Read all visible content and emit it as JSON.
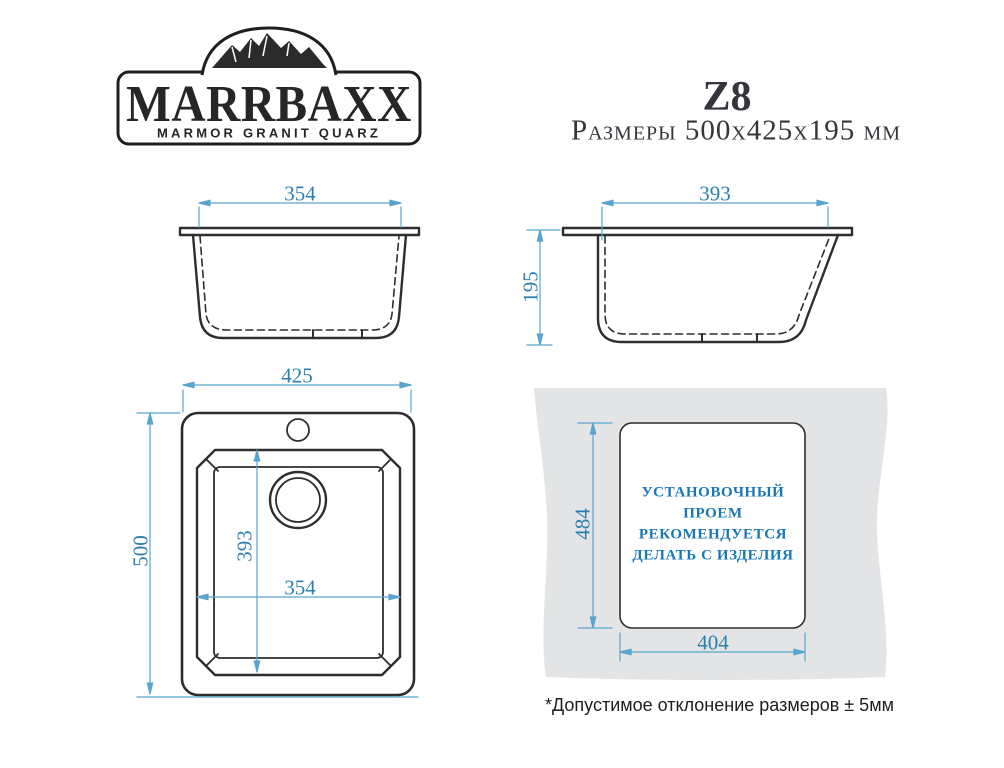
{
  "logo": {
    "brand": "MARRBAXX",
    "tagline": "MARMOR GRANIT QUARZ"
  },
  "header": {
    "model": "Z8",
    "size_label": "Размеры 500х425х195 мм"
  },
  "dimensions": {
    "front_bowl_width": "354",
    "side_bowl_length": "393",
    "side_depth": "195",
    "top_overall_width": "425",
    "top_overall_length": "500",
    "top_bowl_length": "393",
    "top_bowl_width": "354",
    "cutout_length": "484",
    "cutout_width": "404"
  },
  "cutout_note": {
    "lines": [
      "УСТАНОВОЧНЫЙ",
      "ПРОЕМ",
      "РЕКОМЕНДУЕТСЯ",
      "ДЕЛАТЬ С ИЗДЕЛИЯ"
    ]
  },
  "footnote": "*Допустимое отклонение размеров  ± 5мм",
  "colors": {
    "drawing_line": "#2e2e2e",
    "dimension_line": "#5aa5cc",
    "dimension_text": "#2d7fae",
    "cutout_text": "#1877b5",
    "countertop_gray": "#e3e4e5"
  }
}
